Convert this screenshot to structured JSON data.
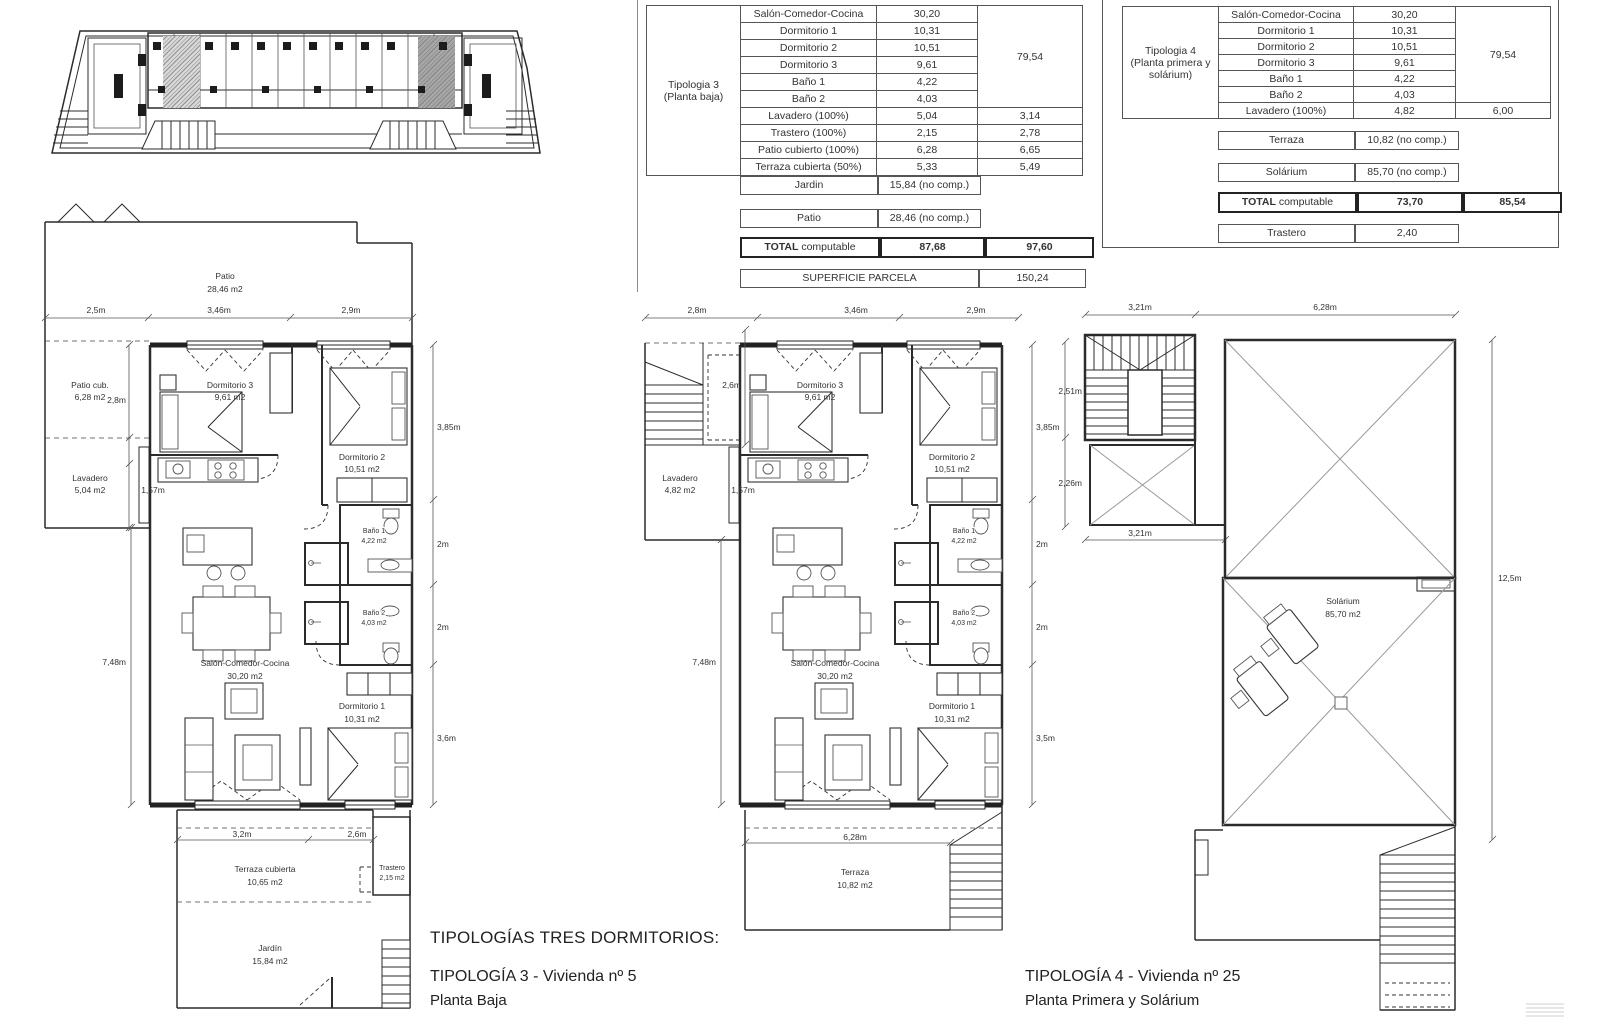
{
  "colors": {
    "line": "#2b2b2b",
    "hatch_grey": "#9a9a9a",
    "solarium_bg": "#f4f6e3",
    "solarium_dot": "#b2c478",
    "highlight_grey": "#a8a8a8"
  },
  "titles": {
    "group": "TIPOLOGÍAS TRES DORMITORIOS:",
    "t3": "TIPOLOGÍA 3 - Vivienda nº 5",
    "t3_sub": "Planta Baja",
    "t4": "TIPOLOGÍA 4 - Vivienda nº 25",
    "t4_sub": "Planta Primera y Solárium"
  },
  "table3": {
    "h1": "Tipologia 3",
    "h2": "(Planta baja)",
    "merged_total": "79,54",
    "rooms": [
      {
        "label": "Salón-Comedor-Cocina",
        "value": "30,20"
      },
      {
        "label": "Dormitorio 1",
        "value": "10,31"
      },
      {
        "label": "Dormitorio 2",
        "value": "10,51"
      },
      {
        "label": "Dormitorio 3",
        "value": "9,61"
      },
      {
        "label": "Baño 1",
        "value": "4,22"
      },
      {
        "label": "Baño 2",
        "value": "4,03"
      },
      {
        "label": "Lavadero (100%)",
        "value": "5,04",
        "value2": "3,14"
      },
      {
        "label": "Trastero (100%)",
        "value": "2,15",
        "value2": "2,78"
      },
      {
        "label": "Patio cubierto (100%)",
        "value": "6,28",
        "value2": "6,65"
      },
      {
        "label": "Terraza cubierta (50%)",
        "value": "5,33",
        "value2": "5,49"
      }
    ],
    "jardin": {
      "label": "Jardin",
      "value": "15,84 (no comp.)"
    },
    "patio": {
      "label": "Patio",
      "value": "28,46 (no comp.)"
    },
    "total": {
      "bold": "TOTAL",
      "rest": " computable",
      "v1": "87,68",
      "v2": "97,60"
    },
    "parcela": {
      "label": "SUPERFICIE PARCELA",
      "value": "150,24"
    }
  },
  "table4": {
    "h1": "Tipologia 4",
    "h2": "(Planta primera y",
    "h3": "solárium)",
    "merged_total": "79,54",
    "rooms": [
      {
        "label": "Salón-Comedor-Cocina",
        "value": "30,20"
      },
      {
        "label": "Dormitorio 1",
        "value": "10,31"
      },
      {
        "label": "Dormitorio 2",
        "value": "10,51"
      },
      {
        "label": "Dormitorio 3",
        "value": "9,61"
      },
      {
        "label": "Baño 1",
        "value": "4,22"
      },
      {
        "label": "Baño 2",
        "value": "4,03"
      },
      {
        "label": "Lavadero (100%)",
        "value": "4,82",
        "value2": "6,00"
      }
    ],
    "terraza": {
      "label": "Terraza",
      "value": "10,82 (no comp.)"
    },
    "solarium": {
      "label": "Solárium",
      "value": "85,70 (no comp.)"
    },
    "total": {
      "bold": "TOTAL",
      "rest": " computable",
      "v1": "73,70",
      "v2": "85,54"
    },
    "trastero": {
      "label": "Trastero",
      "value": "2,40"
    }
  },
  "plan3": {
    "labels": {
      "patio": "Patio",
      "patio_a": "28,46 m2",
      "d25": "2,5m",
      "d346": "3,46m",
      "d29": "2,9m",
      "patiocub": "Patio cub.",
      "patiocub_a": "6,28 m2",
      "d28": "2,8m",
      "dorm3": "Dormitorio 3",
      "dorm3_a": "9,61 m2",
      "dorm2": "Dormitorio 2",
      "dorm2_a": "10,51 m2",
      "lavadero": "Lavadero",
      "lavadero_a": "5,04 m2",
      "d157": "1,57m",
      "d385": "3,85m",
      "bano1": "Baño 1",
      "bano1_a": "4,22 m2",
      "d2a": "2m",
      "bano2": "Baño 2",
      "bano2_a": "4,03 m2",
      "d2b": "2m",
      "d748": "7,48m",
      "salon": "Salón-Comedor-Cocina",
      "salon_a": "30,20 m2",
      "dorm1": "Dormitorio 1",
      "dorm1_a": "10,31 m2",
      "d36": "3,6m",
      "d32": "3,2m",
      "d26": "2,6m",
      "terraza": "Terraza cubierta",
      "terraza_a": "10,65 m2",
      "trastero": "Trastero",
      "trastero_a": "2,15 m2",
      "jardin": "Jardín",
      "jardin_a": "15,84 m2"
    }
  },
  "plan4": {
    "labels": {
      "d28": "2,8m",
      "d346": "3,46m",
      "d29": "2,9m",
      "d26": "2,6m",
      "dorm3": "Dormitorio 3",
      "dorm3_a": "9,61 m2",
      "dorm2": "Dormitorio 2",
      "dorm2_a": "10,51 m2",
      "lavadero": "Lavadero",
      "lavadero_a": "4,82 m2",
      "d157": "1,57m",
      "d385": "3,85m",
      "bano1": "Baño 1",
      "bano1_a": "4,22 m2",
      "d2a": "2m",
      "bano2": "Baño 2",
      "bano2_a": "4,03 m2",
      "d2b": "2m",
      "d748": "7,48m",
      "salon": "Salón-Comedor-Cocina",
      "salon_a": "30,20 m2",
      "dorm1": "Dormitorio 1",
      "dorm1_a": "10,31 m2",
      "d35": "3,5m",
      "d628": "6,28m",
      "terraza": "Terraza",
      "terraza_a": "10,82 m2"
    }
  },
  "solarium": {
    "labels": {
      "d321a": "3,21m",
      "d628": "6,28m",
      "d251": "2,51m",
      "d226": "2,26m",
      "d321b": "3,21m",
      "d125": "12,5m",
      "solarium": "Solárium",
      "solarium_a": "85,70 m2"
    }
  }
}
